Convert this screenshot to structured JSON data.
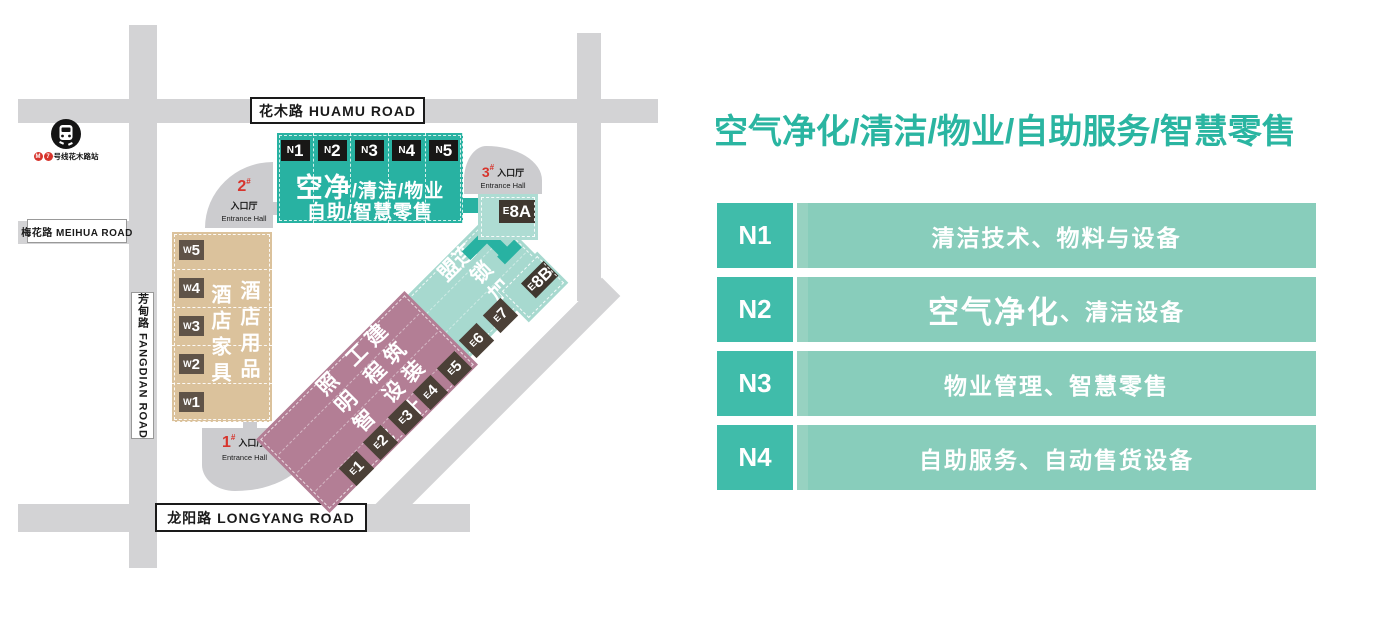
{
  "title": "空气净化/清洁/物业/自助服务/智慧零售",
  "legend": {
    "rows": [
      {
        "hall": "N1",
        "em": "",
        "text": "清洁技术、物料与设备"
      },
      {
        "hall": "N2",
        "em": "空气净化",
        "text": "、清洁设备"
      },
      {
        "hall": "N3",
        "em": "",
        "text": "物业管理、智慧零售"
      },
      {
        "hall": "N4",
        "em": "",
        "text": "自助服务、自动售货设备"
      }
    ]
  },
  "map": {
    "roads": {
      "huamu": "花木路 HUAMU ROAD",
      "meihua": "梅花路 MEIHUA ROAD",
      "fangdian": "芳甸路 FANGDIAN ROAD",
      "longyang": "龙阳路 LONGYANG ROAD"
    },
    "metro": {
      "logo": "M",
      "line": "7",
      "station": "号线花木路站"
    },
    "entrances": {
      "e1": {
        "num": "1",
        "sup": "#",
        "cn": "入口厅",
        "en": "Entrance Hall"
      },
      "e2": {
        "num": "2",
        "sup": "#",
        "cn": "入口厅",
        "en": "Entrance Hall"
      },
      "e3": {
        "num": "3",
        "sup": "#",
        "cn": "入口厅",
        "en": "Entrance Hall"
      }
    },
    "north": {
      "badges": [
        {
          "p": "N",
          "n": "1"
        },
        {
          "p": "N",
          "n": "2"
        },
        {
          "p": "N",
          "n": "3"
        },
        {
          "p": "N",
          "n": "4"
        },
        {
          "p": "N",
          "n": "5"
        }
      ],
      "big": "空净",
      "rest": "/清洁/物业",
      "line2": "自助/智慧零售"
    },
    "west": {
      "badges": [
        {
          "p": "W",
          "n": "5"
        },
        {
          "p": "W",
          "n": "4"
        },
        {
          "p": "W",
          "n": "3"
        },
        {
          "p": "W",
          "n": "2"
        },
        {
          "p": "W",
          "n": "1"
        }
      ],
      "col1": "酒店家具",
      "col2": "酒店用品"
    },
    "pink": {
      "cols": [
        "照明智能",
        "工程设计",
        "建筑装饰"
      ],
      "badges": [
        {
          "p": "E",
          "n": "1"
        },
        {
          "p": "E",
          "n": "2"
        },
        {
          "p": "E",
          "n": "3"
        },
        {
          "p": "E",
          "n": "4"
        },
        {
          "p": "E",
          "n": "5"
        }
      ]
    },
    "franchise": {
      "label": "连锁加盟",
      "badges": [
        {
          "p": "E",
          "n": "6"
        },
        {
          "p": "E",
          "n": "7"
        }
      ]
    },
    "e8a": {
      "p": "E",
      "n": "8A"
    },
    "e8b": {
      "p": "E",
      "n": "8B"
    }
  },
  "colors": {
    "accent_teal": "#2ab5a1",
    "legend_cell_dark": "#40bcaa",
    "legend_cell_light": "#88cdbb",
    "hall_teal": "#28b2a2",
    "hall_pale_teal": "#a7d9cf",
    "hall_pink": "#b37e95",
    "hall_tan": "#dbc29c",
    "road_gray": "#d3d3d5",
    "entrance_red": "#d7342c",
    "badge_black": "#181716",
    "badge_brown": "#4b4037",
    "badge_dark_tan": "#5f5348"
  }
}
